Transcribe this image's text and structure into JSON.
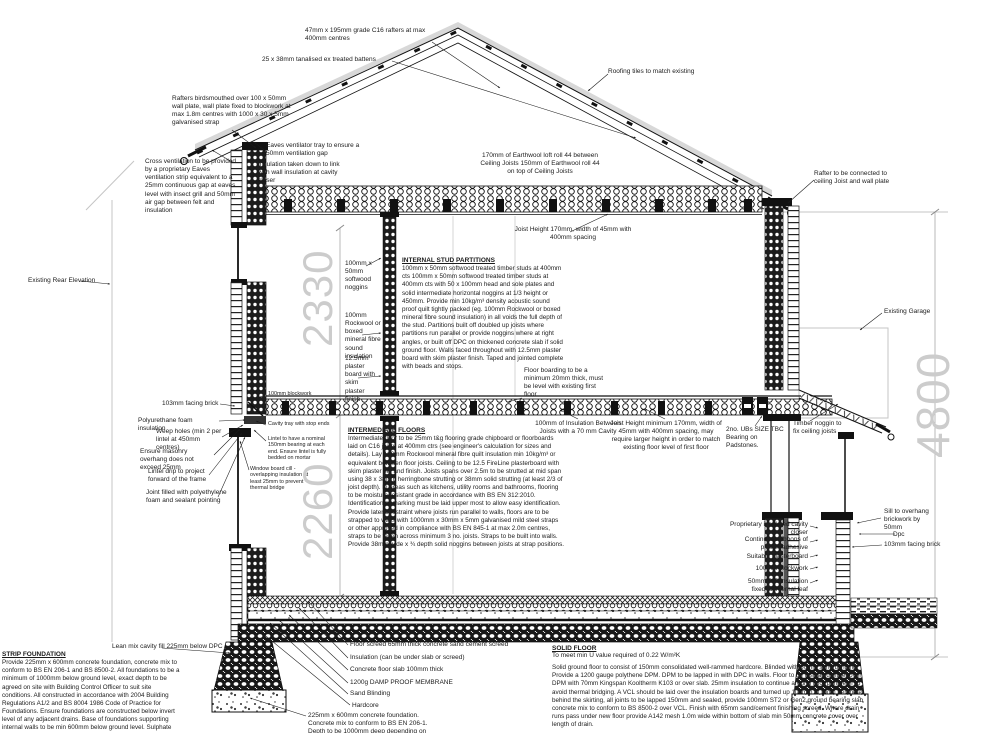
{
  "drawing": {
    "type": "building cross section construction drawing"
  },
  "dimensions": {
    "upper": "2330",
    "lower": "2260",
    "overall": "4800"
  },
  "labels": {
    "rafters": "47mm x 195mm grade C16 rafters at max 400mm centres",
    "battens": "25 x 38mm tanalised ex treated battens",
    "roofing_tiles": "Roofing tiles to match existing",
    "birdsmouth": "Rafters birdsmouthed over 100 x 50mm wall plate, wall plate fixed to blockwork at max 1.8m centres with 1000 x 30 x 5mm galvanised strap",
    "cross_ventilation": "Cross ventilation to be provided by a proprietary Eaves ventilation strip equivalent to a 25mm continuous gap at eaves level with insect grill and 50mm air gap between felt and insulation",
    "eaves_tray": "Eaves ventilator tray to ensure a 50mm ventilation gap",
    "insulation_link": "Insulation taken down to link with wall insulation at cavity closer",
    "earthwool": "170mm of Earthwool loft roll 44 between Ceiling Joists 150mm of Earthwool roll 44 on top of Ceiling Joists",
    "rafter_connection": "Rafter to be connected to ceiling Joist and wall plate",
    "ceiling_joist": "Joist Height 170mm, width of 45mm with 400mm spacing",
    "existing_rear_elevation": "Existing Rear Elevation",
    "noggins": "100mm x 50mm softwood noggins",
    "sound_insulation": "100mm Rockwool or boxed mineral fibre sound insulation",
    "plasterboard": "12.5mm plaster board with skim plaster finish",
    "floor_boarding": "Floor boarding to be a minimum 20mm thick, must be level with existing first floor",
    "insulation_between_joists": "100mm of Insulation Between Joists with a 70 mm Cavity",
    "floor_joist": "Joist Height minimum 170mm, width of 45mm with 400mm spacing, may require larger height in order to match existing floor level of first floor",
    "ubs": "2no. UBs SIZE TBC Bearing on Padstones.",
    "timber_noggin": "Timber noggin to fix ceiling joists",
    "existing_garage": "Existing Garage",
    "facing_brick_left": "103mm facing brick",
    "foam_insulation": "Polyurethane foam insulation",
    "weep_holes": "Weep holes (min 2 per lintel at 450mm centres)",
    "masonry_overhang": "Ensure masonry overhang does not exceed 25mm",
    "lintel_drip": "Lintel drip to project forward of the frame",
    "joint_filled": "Joint filled with polyethylene foam and sealant pointing",
    "blockwork_left": "100mm blockwork",
    "cavity_tray": "Cavity tray with stop ends",
    "lintel_bearing": "Lintel to have a nominal 150mm bearing at each end. Ensure lintel is fully bedded on mortar",
    "window_board": "Window board cill - overlapping insulation at least 25mm to prevent thermal bridge",
    "lean_mix": "Lean mix cavity fill 225mm below DPC",
    "floor_screed": "Floor screed 65mm thick concrete sand cement screed",
    "floor_insulation": "Insulation (can be under slab or screed)",
    "floor_slab": "Concrete floor slab 100mm thick",
    "dpm": "1200g DAMP PROOF MEMBRANE",
    "sand_blinding": "Sand Blinding",
    "hardcore": "Hardcore",
    "foundation_note": "225mm x 600mm concrete foundation. Concrete mix to conform to BS EN 206-1. Depth to be 1000mm deep depending on",
    "cavity_closer": "Proprietary insulated cavity closer",
    "plaster_ribbons": "Continuous ribbons of plaster adhesive",
    "suitable_plasterboard": "Suitable plasterboard",
    "blockwork_right": "100mm blockwork",
    "pir": "50mm PIR insulation fixed to internal leaf",
    "facing_brick_right": "103mm facing brick",
    "sill_overhang": "Sill to overhang brickwork by 50mm",
    "dpc": "Dpc"
  },
  "notes": {
    "internal_stud_partitions": {
      "heading": "INTERNAL STUD PARTITIONS",
      "body": "100mm x 50mm softwood treated timber studs at 400mm cts 100mm x 50mm softwood treated timber studs at 400mm cts with 50 x 100mm head and sole plates and solid intermediate horizontal noggins at 1/3 height or 450mm. Provide min 10kg/m³ density acoustic sound proof quilt tightly packed (eg. 100mm Rockwool or boxed mineral fibre sound insulation) in all voids the full depth of the stud. Partitions built off doubled up joists where partitions run parallel or provide noggins where at right angles, or built off DPC on thickened concrete slab if solid ground floor. Walls faced throughout with 12.5mm plaster board with skim plaster finish. Taped and jointed complete with beads and stops."
    },
    "intermediate_floors": {
      "heading": "INTERMEDIATE FLOORS",
      "body": "Intermediate floor to be 25mm t&g flooring grade chipboard or floorboards laid on C16 joists at 400mm ctrs (see engineer's calculation for sizes and details). Lay 100mm Rockwool mineral fibre quilt insulation min 10kg/m³ or equivalent between floor joists. Ceiling to be 12.5 FireLine plasterboard with skim plaster set and finish. Joists spans over 2.5m to be strutted at mid span using 38 x 38mm herringbone strutting or 38mm solid strutting (at least 2/3 of joist depth). In areas such as kitchens, utility rooms and bathrooms, flooring to be moisture resistant grade in accordance with BS EN 312:2010. Identification or marking must be laid upper most to allow easy identification. Provide lateral restraint where joists run parallel to walls, floors are to be strapped to walls with 1000mm x 30mm x 5mm galvanised mild steel straps or other approved in compliance with BS EN 845-1 at max 2.0m centres, straps to be taken across minimum 3 no. joists. Straps to be built into walls. Provide 38mm wide x ¾ depth solid noggins between joists at strap positions."
    },
    "strip_foundation": {
      "heading": "STRIP FOUNDATION",
      "body": "Provide 225mm x 600mm concrete foundation, concrete mix to conform to BS EN 206-1 and BS 8500-2. All foundations to be a minimum of 1000mm below ground level, exact depth to be agreed on site with Building Control Officer to suit site conditions. All constructed in accordance with 2004 Building Regulations A1/2 and BS 8004 1986 Code of Practice for Foundations. Ensure foundations are constructed below invert level of any adjacent drains. Base of foundations supporting internal walls to be min 600mm below ground level. Sulphate resistant cement to be used if required. Please note that should any adverse soil conditions be found or any major tree roots in excavations, the Building Control Officer is to be contacted and the advice of a structural engineer should be sought."
    },
    "solid_floor": {
      "heading": "SOLID FLOOR",
      "subheading": "To meet min U value required of 0.22 W/m²K",
      "body": "Solid ground floor to consist of 150mm consolidated well-rammed hardcore. Blinded with 50mm sand blinding. Provide a 1200 gauge polythene DPM. DPM to be lapped in with DPC in walls. Floor to be insulated either over DPM with 70mm Kingspan Kooltherm K103 or over slab. 25mm insulation to continue around floor perimeter to avoid thermal bridging. A VCL should be laid over the insulation boards and turned up 100mm at room perimeter behind the skirting, all joints to be lapped 150mm and sealed, provide 100mm ST2 or Gen2 ground bearing slab concrete mix to conform to BS 8500-2 over VCL. Finish with 65mm sand/cement finishing screed. Where drain runs pass under new floor provide A142 mesh 1.0m wide within bottom of slab min 50mm concrete cover over length of drain."
    }
  },
  "colors": {
    "line": "#1a1a1a",
    "dim_text": "#cccccc",
    "reference_gray": "#c5c5c5",
    "tile_band": "#d8d8d8"
  }
}
